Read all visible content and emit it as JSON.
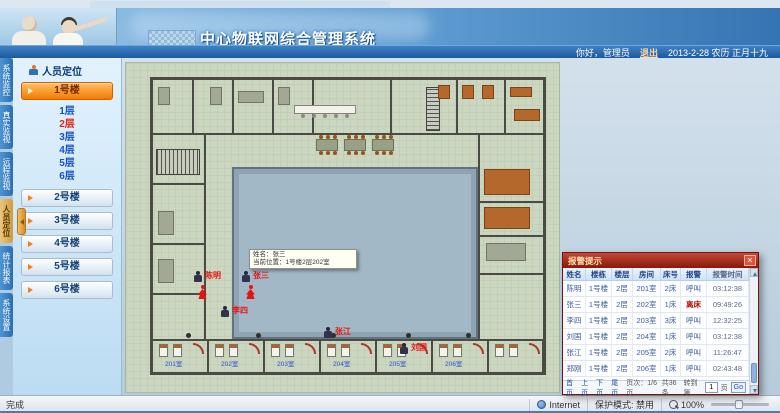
{
  "header": {
    "title": "中心物联网综合管理系统",
    "greeting": "你好，管理员",
    "logout_label": "退出",
    "date": "2013-2-28 农历 正月十九"
  },
  "sidebar": {
    "tabs": [
      "系统监控",
      "真实监视",
      "远程监视",
      "人员定位",
      "统计报表",
      "系统设置"
    ],
    "active_tab": "人员定位",
    "panel_title": "人员定位",
    "buildings": [
      "1号楼",
      "2号楼",
      "3号楼",
      "4号楼",
      "5号楼",
      "6号楼"
    ],
    "active_building": "1号楼",
    "floors": [
      "1层",
      "2层",
      "3层",
      "4层",
      "5层",
      "6层"
    ],
    "active_floor": "2层"
  },
  "plan": {
    "room_labels": [
      "201室",
      "202室",
      "203室",
      "204室",
      "205室",
      "206室"
    ],
    "markers": [
      {
        "name": "陈明"
      },
      {
        "name": "张三"
      },
      {
        "name": "李四"
      },
      {
        "name": "张江"
      },
      {
        "name": "刘国"
      }
    ],
    "tooltip": {
      "line1": "姓名：张三",
      "line2": "当前位置：1号楼2层202室"
    }
  },
  "alarm_popup": {
    "title": "报警提示",
    "close_label": "✕",
    "columns": [
      "姓名",
      "楼栋",
      "楼层",
      "房间",
      "床号",
      "报警",
      "报警时间"
    ],
    "rows": [
      [
        "陈明",
        "1号楼",
        "2层",
        "201室",
        "2床",
        "呼叫",
        "03:12:38"
      ],
      [
        "张三",
        "1号楼",
        "2层",
        "202室",
        "1床",
        "离床",
        "09:49:26"
      ],
      [
        "李四",
        "1号楼",
        "2层",
        "203室",
        "3床",
        "呼叫",
        "12:32:25"
      ],
      [
        "刘国",
        "1号楼",
        "2层",
        "204室",
        "1床",
        "呼叫",
        "03:12:38"
      ],
      [
        "张江",
        "1号楼",
        "2层",
        "205室",
        "2床",
        "呼叫",
        "11:26:47"
      ],
      [
        "郑刚",
        "1号楼",
        "2层",
        "206室",
        "1床",
        "呼叫",
        "02:43:48"
      ]
    ],
    "pagination": {
      "first": "首页",
      "prev": "上页",
      "next": "下页",
      "last": "尾页",
      "page_info": "页次：1/6页",
      "total": "共36条",
      "goto_prefix": "转到第",
      "goto_value": "1",
      "goto_suffix": "页",
      "go_label": "Go"
    }
  },
  "status_bar": {
    "left": "完成",
    "zone": "Internet",
    "protected_mode": "保护模式: 禁用",
    "zoom_level": "100%"
  },
  "colors": {
    "accent_orange": "#f57a00",
    "alarm_red": "#e41414",
    "header_blue": "#2f6fb8",
    "popup_red": "#8a1808",
    "courtyard_blue": "#a2b8c6",
    "plan_green": "#ccd7c2"
  }
}
